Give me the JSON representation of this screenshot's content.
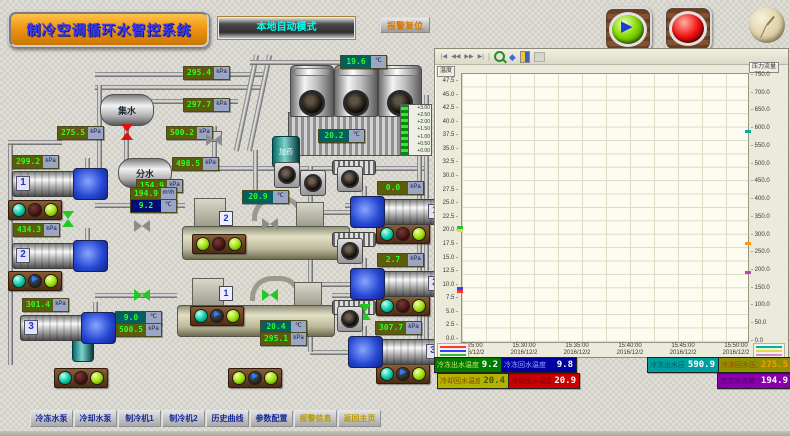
{
  "header": {
    "title": "制冷空调循环水智控系统",
    "mode_label": "本地自动模式",
    "alarm_reset_label": "报警复位"
  },
  "diagram": {
    "tanks": {
      "collector": "集水",
      "distributor": "分水",
      "dosing": "加药"
    },
    "chiller_badges": [
      "2",
      "1"
    ],
    "level_gauge_ticks": [
      "+3.00",
      "+2.50",
      "+2.00",
      "+1.50",
      "+1.00",
      "+0.50",
      "+0.00"
    ],
    "displays": [
      {
        "x": 183,
        "y": 66,
        "value": "295.4",
        "unit": "kPa",
        "style": "olive"
      },
      {
        "x": 183,
        "y": 98,
        "value": "297.7",
        "unit": "kPa",
        "style": "olive"
      },
      {
        "x": 57,
        "y": 126,
        "value": "275.5",
        "unit": "kPa",
        "style": "olive"
      },
      {
        "x": 166,
        "y": 126,
        "value": "500.2",
        "unit": "kPa",
        "style": "olive"
      },
      {
        "x": 172,
        "y": 157,
        "value": "498.5",
        "unit": "kPa",
        "style": "olive"
      },
      {
        "x": 136,
        "y": 179,
        "value": "154.9",
        "unit": "kPa",
        "style": "olive"
      },
      {
        "x": 12,
        "y": 155,
        "value": "299.2",
        "unit": "kPa",
        "style": "olive"
      },
      {
        "x": 13,
        "y": 223,
        "value": "434.3",
        "unit": "kPa",
        "style": "olive"
      },
      {
        "x": 22,
        "y": 298,
        "value": "301.4",
        "unit": "kPa",
        "style": "olive"
      },
      {
        "x": 130,
        "y": 187,
        "value": "194.9",
        "unit": "m³/h",
        "style": "olive"
      },
      {
        "x": 130,
        "y": 199,
        "value": "9.2",
        "unit": "℃",
        "style": "navy"
      },
      {
        "x": 242,
        "y": 190,
        "value": "20.9",
        "unit": "℃",
        "style": "teal"
      },
      {
        "x": 340,
        "y": 55,
        "value": "19.6",
        "unit": "℃",
        "style": "teal"
      },
      {
        "x": 318,
        "y": 129,
        "value": "20.2",
        "unit": "℃",
        "style": "teal"
      },
      {
        "x": 115,
        "y": 311,
        "value": "9.0",
        "unit": "℃",
        "style": "teal"
      },
      {
        "x": 115,
        "y": 323,
        "value": "500.5",
        "unit": "kPa",
        "style": "olive"
      },
      {
        "x": 260,
        "y": 320,
        "value": "20.4",
        "unit": "℃",
        "style": "teal"
      },
      {
        "x": 260,
        "y": 332,
        "value": "295.1",
        "unit": "kPa",
        "style": "olive"
      },
      {
        "x": 377,
        "y": 181,
        "value": "0.0",
        "unit": "kPa",
        "style": "olive"
      },
      {
        "x": 377,
        "y": 253,
        "value": "2.7",
        "unit": "kPa",
        "style": "olive"
      },
      {
        "x": 375,
        "y": 321,
        "value": "307.7",
        "unit": "kPa",
        "style": "olive"
      }
    ],
    "lights": [
      {
        "x": 8,
        "y": 200,
        "states": [
          "teal",
          "dark",
          "green"
        ]
      },
      {
        "x": 8,
        "y": 271,
        "states": [
          "teal",
          "play",
          "green"
        ]
      },
      {
        "x": 54,
        "y": 368,
        "states": [
          "teal",
          "dark",
          "green"
        ]
      },
      {
        "x": 192,
        "y": 234,
        "states": [
          "green",
          "dark",
          "green"
        ]
      },
      {
        "x": 190,
        "y": 306,
        "states": [
          "teal",
          "play",
          "green"
        ]
      },
      {
        "x": 376,
        "y": 224,
        "states": [
          "teal",
          "dark",
          "green"
        ]
      },
      {
        "x": 376,
        "y": 296,
        "states": [
          "teal",
          "dark",
          "green"
        ]
      },
      {
        "x": 376,
        "y": 364,
        "states": [
          "teal",
          "play",
          "green"
        ]
      },
      {
        "x": 228,
        "y": 368,
        "states": [
          "green",
          "play",
          "green"
        ]
      }
    ],
    "valves": [
      {
        "x": 119,
        "y": 126,
        "c": "red",
        "o": "v"
      },
      {
        "x": 60,
        "y": 213,
        "c": "green",
        "o": "v"
      },
      {
        "x": 134,
        "y": 289,
        "c": "green",
        "o": "h"
      },
      {
        "x": 262,
        "y": 289,
        "c": "green",
        "o": "h"
      },
      {
        "x": 134,
        "y": 220,
        "c": "gray",
        "o": "h"
      },
      {
        "x": 262,
        "y": 218,
        "c": "gray",
        "o": "h"
      },
      {
        "x": 357,
        "y": 306,
        "c": "green",
        "o": "v"
      },
      {
        "x": 206,
        "y": 134,
        "c": "gray",
        "o": "h"
      }
    ],
    "pumps": {
      "left": [
        {
          "x": 12,
          "y": 168,
          "num": "1"
        },
        {
          "x": 12,
          "y": 240,
          "num": "2"
        },
        {
          "x": 20,
          "y": 312,
          "num": "3"
        }
      ],
      "right": [
        {
          "x": 350,
          "y": 196,
          "num": "1"
        },
        {
          "x": 350,
          "y": 268,
          "num": "2"
        },
        {
          "x": 348,
          "y": 336,
          "num": "3"
        }
      ]
    },
    "fans": [
      {
        "x": 300,
        "y": 170
      },
      {
        "x": 337,
        "y": 166
      },
      {
        "x": 337,
        "y": 238
      },
      {
        "x": 337,
        "y": 306
      },
      {
        "x": 274,
        "y": 162
      }
    ]
  },
  "chart": {
    "toolbar": {
      "first": "|◀",
      "prev": "◀◀",
      "next": "▶▶",
      "last": "▶|",
      "pan": "◆"
    },
    "y_left_label": "温度",
    "y_right_label": "压力流量",
    "y_left_ticks": [
      "47.5",
      "45.0",
      "42.5",
      "40.0",
      "37.5",
      "35.0",
      "32.5",
      "30.0",
      "27.5",
      "25.0",
      "22.5",
      "20.0",
      "17.5",
      "15.0",
      "12.5",
      "10.0",
      "7.5",
      "5.0",
      "2.5",
      "0.0"
    ],
    "y_right_ticks": [
      "750.0",
      "700.0",
      "650.0",
      "600.0",
      "550.0",
      "500.0",
      "450.0",
      "400.0",
      "350.0",
      "300.0",
      "250.0",
      "200.0",
      "150.0",
      "100.0",
      "50.0",
      "0.0"
    ],
    "x_ticks": [
      {
        "time": "15:25:00",
        "date": "2016/12/2"
      },
      {
        "time": "15:30:00",
        "date": "2016/12/2"
      },
      {
        "time": "15:35:00",
        "date": "2016/12/2"
      },
      {
        "time": "15:40:00",
        "date": "2016/12/2"
      },
      {
        "time": "15:45:00",
        "date": "2016/12/2"
      },
      {
        "time": "15:50:00",
        "date": "2016/12/2"
      }
    ],
    "legend_left_colors": [
      "#ff3333",
      "#3344ff",
      "#33bb33",
      "#dddd33"
    ],
    "legend_right_colors": [
      "#00b0a0",
      "#dddd44",
      "#dd88cc"
    ]
  },
  "chart_data": {
    "type": "line",
    "title": "实时趋势",
    "x_ticks": [
      "15:25:00",
      "15:30:00",
      "15:35:00",
      "15:40:00",
      "15:45:00",
      "15:50:00"
    ],
    "x_date": "2016/12/2",
    "y_left": {
      "label": "温度",
      "min": 0,
      "max": 47.5,
      "step": 2.5
    },
    "y_right": {
      "label": "压力流量",
      "min": 0,
      "max": 750,
      "step": 50
    },
    "grid": true,
    "series": [
      {
        "name": "冷冻出水温度",
        "color": "#ff3333",
        "axis": "left",
        "current": 9.2,
        "values": []
      },
      {
        "name": "冷冻回水温度",
        "color": "#3344ff",
        "axis": "left",
        "current": 9.8,
        "values": []
      },
      {
        "name": "冷却回水温度",
        "color": "#dddd33",
        "axis": "left",
        "current": 20.4,
        "values": []
      },
      {
        "name": "冷却出水温度",
        "color": "#33bb33",
        "axis": "left",
        "current": 20.9,
        "values": []
      },
      {
        "name": "冷冻出水压力",
        "color": "#00b0a0",
        "axis": "right",
        "current": 590.9,
        "values": []
      },
      {
        "name": "冷冻回水压力",
        "color": "#ff9900",
        "axis": "right",
        "current": 275.5,
        "values": []
      },
      {
        "name": "冷冻水流量",
        "color": "#bb44bb",
        "axis": "right",
        "current": 194.9,
        "values": []
      }
    ]
  },
  "status_bars": {
    "row1": [
      {
        "label": "冷冻出水温度",
        "value": "9.2",
        "bg": "#017a01",
        "label_fg": "#cfe768",
        "fg": "#ffffff"
      },
      {
        "label": "冷冻回水温度",
        "value": "9.8",
        "bg": "#0000a0",
        "label_fg": "#8fa7ff",
        "fg": "#ffffff"
      },
      {
        "label": "冷冻出水压力",
        "value": "590.9",
        "bg": "#00a0a0",
        "label_fg": "#045b5b",
        "fg": "#ffffff"
      },
      {
        "label": "冷冻回水压力",
        "value": "275.5",
        "bg": "#8f8f00",
        "label_fg": "#9c4a00",
        "fg": "#ff9900"
      }
    ],
    "row2": [
      {
        "label": "冷却回水温度",
        "value": "20.4",
        "bg": "#b2b200",
        "label_fg": "#8a4500",
        "fg": "#4a5500"
      },
      {
        "label": "冷却出水温度",
        "value": "20.9",
        "bg": "#cc0000",
        "label_fg": "#7e0000",
        "fg": "#ffffff"
      },
      {
        "label": "冷冻水流量",
        "value": "194.9",
        "bg": "#8800aa",
        "label_fg": "#4d0061",
        "fg": "#ffffff"
      }
    ]
  },
  "nav": {
    "items": [
      {
        "label": "冷冻水泵",
        "gold": false
      },
      {
        "label": "冷却水泵",
        "gold": false
      },
      {
        "label": "制冷机1",
        "gold": false
      },
      {
        "label": "制冷机2",
        "gold": false
      },
      {
        "label": "历史曲线",
        "gold": false
      },
      {
        "label": "参数配置",
        "gold": false
      },
      {
        "label": "报警信息",
        "gold": true
      },
      {
        "label": "返回主页",
        "gold": true
      }
    ]
  }
}
